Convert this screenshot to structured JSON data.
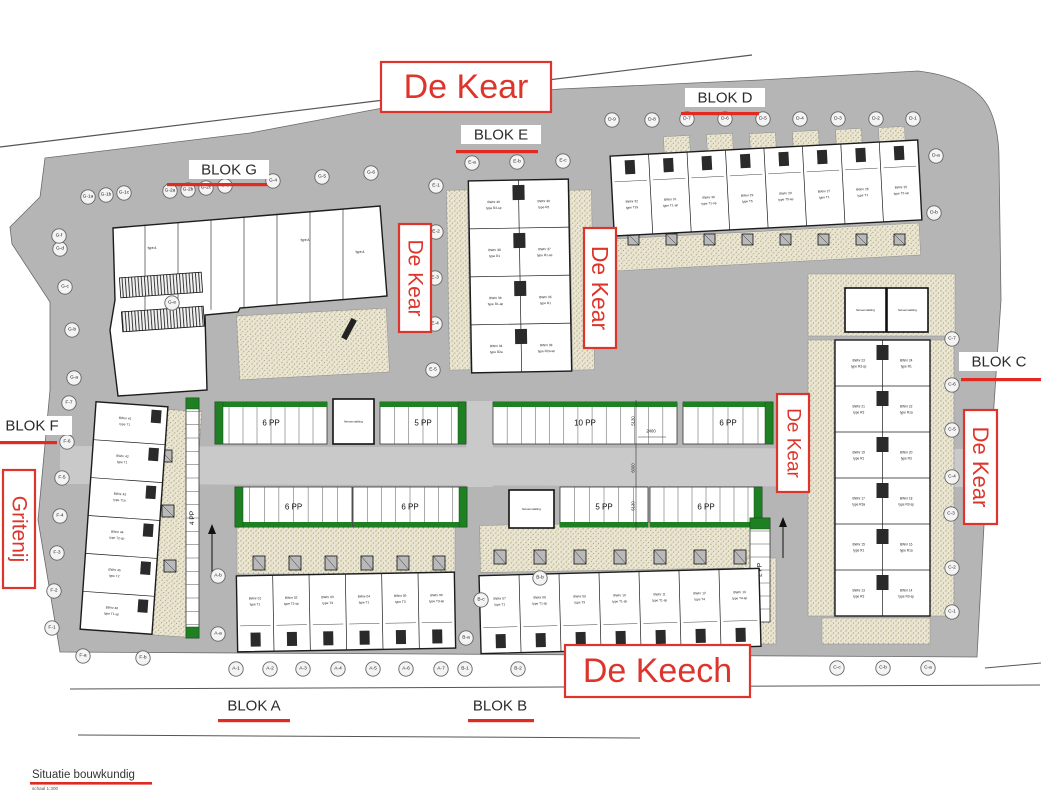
{
  "footer": {
    "title": "Situatie bouwkundig",
    "scale": "schaal 1:300"
  },
  "street_labels": [
    {
      "text": "De Kear",
      "x": 381,
      "y": 62,
      "w": 170,
      "h": 50,
      "fs": 34,
      "vertical": false
    },
    {
      "text": "De Kear",
      "x": 399,
      "y": 224,
      "w": 32,
      "h": 108,
      "fs": 21,
      "vertical": true
    },
    {
      "text": "De Kear",
      "x": 584,
      "y": 228,
      "w": 32,
      "h": 120,
      "fs": 23,
      "vertical": true
    },
    {
      "text": "De Kear",
      "x": 777,
      "y": 394,
      "w": 32,
      "h": 98,
      "fs": 19,
      "vertical": true
    },
    {
      "text": "De Kear",
      "x": 964,
      "y": 410,
      "w": 33,
      "h": 114,
      "fs": 22,
      "vertical": true
    },
    {
      "text": "Gritenij",
      "x": 3,
      "y": 470,
      "w": 32,
      "h": 118,
      "fs": 21,
      "vertical": true
    },
    {
      "text": "De Keech",
      "x": 565,
      "y": 645,
      "w": 185,
      "h": 52,
      "fs": 34,
      "vertical": false
    }
  ],
  "blok_labels": [
    {
      "text": "BLOK A",
      "x": 254,
      "y": 712,
      "ul": [
        218,
        719,
        72
      ],
      "bg": false
    },
    {
      "text": "BLOK B",
      "x": 500,
      "y": 712,
      "ul": [
        468,
        719,
        66
      ],
      "bg": false
    },
    {
      "text": "BLOK C",
      "x": 999,
      "y": 368,
      "ul": [
        961,
        378,
        80
      ],
      "bg": true
    },
    {
      "text": "BLOK D",
      "x": 725,
      "y": 104,
      "ul": [
        681,
        112,
        78
      ],
      "bg": true
    },
    {
      "text": "BLOK E",
      "x": 501,
      "y": 141,
      "ul": [
        456,
        150,
        82
      ],
      "bg": true
    },
    {
      "text": "BLOK F",
      "x": 32,
      "y": 432,
      "ul": [
        0,
        441,
        57
      ],
      "bg": true
    },
    {
      "text": "BLOK G",
      "x": 229,
      "y": 176,
      "ul": [
        167,
        183,
        100
      ],
      "bg": true
    }
  ],
  "markers": [
    {
      "l": "G-1a",
      "x": 88,
      "y": 197
    },
    {
      "l": "G-1b",
      "x": 106,
      "y": 195
    },
    {
      "l": "G-1c",
      "x": 124,
      "y": 193
    },
    {
      "l": "G-2a",
      "x": 170,
      "y": 191
    },
    {
      "l": "G-2b",
      "x": 188,
      "y": 190
    },
    {
      "l": "G-2c",
      "x": 206,
      "y": 188
    },
    {
      "l": "G-3",
      "x": 225,
      "y": 186
    },
    {
      "l": "G-4",
      "x": 273,
      "y": 181
    },
    {
      "l": "G-5",
      "x": 322,
      "y": 177
    },
    {
      "l": "G-6",
      "x": 371,
      "y": 173
    },
    {
      "l": "E-a",
      "x": 472,
      "y": 163
    },
    {
      "l": "E-b",
      "x": 517,
      "y": 162
    },
    {
      "l": "E-c",
      "x": 563,
      "y": 161
    },
    {
      "l": "D-9",
      "x": 612,
      "y": 120
    },
    {
      "l": "D-8",
      "x": 652,
      "y": 120
    },
    {
      "l": "D-7",
      "x": 687,
      "y": 119
    },
    {
      "l": "D-6",
      "x": 725,
      "y": 119
    },
    {
      "l": "D-5",
      "x": 763,
      "y": 119
    },
    {
      "l": "D-4",
      "x": 800,
      "y": 119
    },
    {
      "l": "D-3",
      "x": 838,
      "y": 119
    },
    {
      "l": "D-2",
      "x": 876,
      "y": 119
    },
    {
      "l": "D-1",
      "x": 913,
      "y": 119
    },
    {
      "l": "D-a",
      "x": 936,
      "y": 156
    },
    {
      "l": "D-b",
      "x": 934,
      "y": 213
    },
    {
      "l": "C-7",
      "x": 952,
      "y": 339
    },
    {
      "l": "C-6",
      "x": 952,
      "y": 385
    },
    {
      "l": "C-5",
      "x": 952,
      "y": 430
    },
    {
      "l": "C-4",
      "x": 952,
      "y": 477
    },
    {
      "l": "C-3",
      "x": 951,
      "y": 514
    },
    {
      "l": "C-2",
      "x": 952,
      "y": 568
    },
    {
      "l": "C-1",
      "x": 952,
      "y": 612
    },
    {
      "l": "C-a",
      "x": 928,
      "y": 668
    },
    {
      "l": "C-b",
      "x": 883,
      "y": 668
    },
    {
      "l": "C-c",
      "x": 837,
      "y": 668
    },
    {
      "l": "B-2",
      "x": 518,
      "y": 669
    },
    {
      "l": "B-1",
      "x": 465,
      "y": 669
    },
    {
      "l": "A-7",
      "x": 441,
      "y": 669
    },
    {
      "l": "A-6",
      "x": 406,
      "y": 669
    },
    {
      "l": "A-5",
      "x": 373,
      "y": 669
    },
    {
      "l": "A-4",
      "x": 338,
      "y": 669
    },
    {
      "l": "A-3",
      "x": 303,
      "y": 669
    },
    {
      "l": "A-2",
      "x": 270,
      "y": 669
    },
    {
      "l": "A-1",
      "x": 236,
      "y": 669
    },
    {
      "l": "F-b",
      "x": 143,
      "y": 658
    },
    {
      "l": "F-a",
      "x": 83,
      "y": 656
    },
    {
      "l": "F-1",
      "x": 52,
      "y": 628
    },
    {
      "l": "F-2",
      "x": 54,
      "y": 591
    },
    {
      "l": "F-3",
      "x": 57,
      "y": 553
    },
    {
      "l": "F-4",
      "x": 60,
      "y": 516
    },
    {
      "l": "F-5",
      "x": 62,
      "y": 478
    },
    {
      "l": "F-6",
      "x": 67,
      "y": 442
    },
    {
      "l": "F-7",
      "x": 69,
      "y": 403
    },
    {
      "l": "G-a",
      "x": 74,
      "y": 378
    },
    {
      "l": "G-b",
      "x": 72,
      "y": 330
    },
    {
      "l": "G-c",
      "x": 65,
      "y": 287
    },
    {
      "l": "G-d",
      "x": 60,
      "y": 249
    },
    {
      "l": "G-f",
      "x": 59,
      "y": 236
    },
    {
      "l": "E-1",
      "x": 436,
      "y": 186
    },
    {
      "l": "E-2",
      "x": 436,
      "y": 232
    },
    {
      "l": "E-3",
      "x": 435,
      "y": 278
    },
    {
      "l": "E-4",
      "x": 435,
      "y": 324
    },
    {
      "l": "E-5",
      "x": 433,
      "y": 370
    },
    {
      "l": "A-b",
      "x": 218,
      "y": 576
    },
    {
      "l": "A-a",
      "x": 218,
      "y": 634
    },
    {
      "l": "B-a",
      "x": 466,
      "y": 638
    },
    {
      "l": "B-b",
      "x": 540,
      "y": 578
    },
    {
      "l": "B-c",
      "x": 481,
      "y": 600
    },
    {
      "l": "G-e",
      "x": 172,
      "y": 303
    }
  ],
  "parking": {
    "rows": [
      {
        "y": 402,
        "h": 42,
        "band": "top",
        "segs": [
          {
            "x": 215,
            "w": 112,
            "label": "6 PP",
            "gl": true
          },
          {
            "x": 380,
            "w": 86,
            "label": "5 PP",
            "gr": true
          },
          {
            "x": 493,
            "w": 184,
            "label": "10 PP"
          },
          {
            "x": 683,
            "w": 90,
            "label": "6 PP",
            "gr": true
          }
        ]
      },
      {
        "y": 487,
        "h": 40,
        "band": "bottom",
        "segs": [
          {
            "x": 235,
            "w": 117,
            "label": "6 PP",
            "gl": true
          },
          {
            "x": 353,
            "w": 114,
            "label": "6 PP",
            "gr": true
          },
          {
            "x": 560,
            "w": 88,
            "label": "5 PP"
          },
          {
            "x": 650,
            "w": 112,
            "label": "6 PP",
            "gr": true
          }
        ]
      }
    ],
    "side": [
      {
        "x": 186,
        "y": 398,
        "w": 13,
        "h": 240,
        "label": "4 PP",
        "gt": true,
        "gb": true
      },
      {
        "x": 750,
        "y": 518,
        "w": 20,
        "h": 104,
        "label": "2 PP",
        "gt": true
      }
    ],
    "bike_label": "fietsenstalling",
    "bike_sheds": [
      {
        "x": 333,
        "y": 399,
        "w": 41,
        "h": 45
      },
      {
        "x": 509,
        "y": 490,
        "w": 45,
        "h": 38
      },
      {
        "x": 845,
        "y": 288,
        "w": 41,
        "h": 44
      },
      {
        "x": 887,
        "y": 288,
        "w": 41,
        "h": 44
      }
    ]
  },
  "dims": {
    "line_x": 636,
    "v": [
      {
        "t": "5130",
        "y": 421
      },
      {
        "t": "6000",
        "y": 468
      },
      {
        "t": "5130",
        "y": 506
      }
    ],
    "h": {
      "t": "2400",
      "x": 651,
      "y": 431
    }
  },
  "blocks": {
    "A": {
      "x": 237,
      "y": 574,
      "w": 218,
      "h": 76,
      "rot": -1,
      "units": [
        [
          "BWnr 01",
          "type T1"
        ],
        [
          "BWnr 02",
          "type T2-sp"
        ],
        [
          "BWnr 03",
          "type T3"
        ],
        [
          "BWnr 04",
          "type T1"
        ],
        [
          "BWnr 05",
          "type T3"
        ],
        [
          "BWnr 06",
          "type T3-sp"
        ]
      ]
    },
    "B": {
      "x": 480,
      "y": 572,
      "w": 280,
      "h": 78,
      "rot": -1.5,
      "units": [
        [
          "BWnr 07",
          "type T1"
        ],
        [
          "BWnr 08",
          "type T1-sp"
        ],
        [
          "BWnr 09",
          "type T3"
        ],
        [
          "BWnr 10",
          "type T1-sp"
        ],
        [
          "BWnr 11",
          "type T1-sp"
        ],
        [
          "BWnr 12",
          "type T4"
        ],
        [
          "BWnr 13",
          "type T4-sp"
        ]
      ]
    },
    "D": {
      "x": 612,
      "y": 148,
      "w": 308,
      "h": 80,
      "rot": -3,
      "units": [
        [
          "BWnr 32",
          "type T2a"
        ],
        [
          "BWnr 31",
          "type T1-sp"
        ],
        [
          "BWnr 30",
          "type T1-sp"
        ],
        [
          "BWnr 29",
          "type T5"
        ],
        [
          "BWnr 28",
          "type T5-sp"
        ],
        [
          "BWnr 27",
          "type T1"
        ],
        [
          "BWnr 26",
          "type T1"
        ],
        [
          "BWnr 25",
          "type T2-sp"
        ]
      ]
    },
    "E": {
      "x": 470,
      "y": 180,
      "w": 100,
      "h": 192,
      "rot": -1,
      "rows": [
        [
          [
            "BWnr 40",
            "type R2-sp"
          ],
          [
            "BWnr 39",
            "type R2"
          ]
        ],
        [
          [
            "BWnr 38",
            "type R1"
          ],
          [
            "BWnr 37",
            "type R1-sp"
          ]
        ],
        [
          [
            "BWnr 36",
            "type R1-sp"
          ],
          [
            "BWnr 35",
            "type R1"
          ]
        ],
        [
          [
            "BWnr 34",
            "type R2a"
          ],
          [
            "BWnr 33",
            "type R2a-sp"
          ]
        ]
      ]
    },
    "C": {
      "x": 835,
      "y": 340,
      "w": 95,
      "h": 276,
      "rot": 0,
      "rows": [
        [
          [
            "BWnr 23",
            "type R3-sp"
          ],
          [
            "BWnr 24",
            "type R1"
          ]
        ],
        [
          [
            "BWnr 21",
            "type R3"
          ],
          [
            "BWnr 22",
            "type R1a"
          ]
        ],
        [
          [
            "BWnr 19",
            "type R1"
          ],
          [
            "BWnr 20",
            "type R3"
          ]
        ],
        [
          [
            "BWnr 17",
            "type R3a"
          ],
          [
            "BWnr 18",
            "type R3-sp"
          ]
        ],
        [
          [
            "BWnr 15",
            "type R1"
          ],
          [
            "BWnr 16",
            "type R1a"
          ]
        ],
        [
          [
            "BWnr 13",
            "type R3"
          ],
          [
            "BWnr 14",
            "type R3-sp"
          ]
        ]
      ]
    },
    "F": {
      "x": 88,
      "y": 404,
      "w": 72,
      "h": 228,
      "rot": 4,
      "units": [
        [
          "BWnr 41",
          "type T1"
        ],
        [
          "BWnr 42",
          "type T1"
        ],
        [
          "BWnr 43",
          "type T1a"
        ],
        [
          "BWnr 44",
          "type T2-sp"
        ],
        [
          "BWnr 45",
          "type T2"
        ],
        [
          "BWnr 46",
          "type T1-sp"
        ]
      ]
    },
    "G": {
      "labels": [
        "type A",
        "type A",
        "type A"
      ]
    }
  },
  "colors": {
    "road": "#b5b5b5",
    "aisle": "#c9c9c9",
    "green": "#1e7f23",
    "red": "#dd352c",
    "red_line": "#e02a22",
    "stipple_bg": "#eae6d3",
    "ink": "#1c1c1c"
  }
}
